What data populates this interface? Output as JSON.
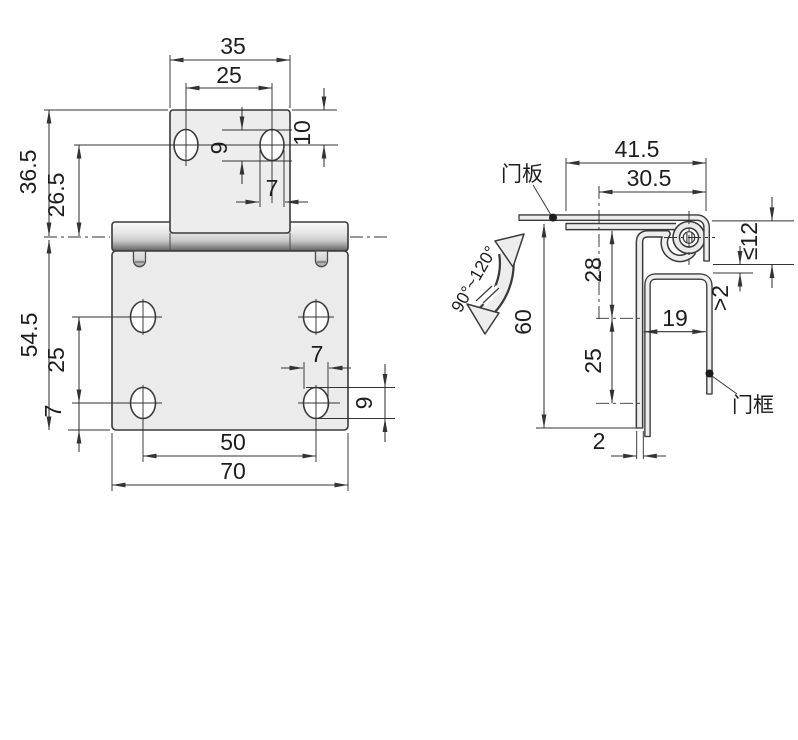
{
  "front_view": {
    "dims": {
      "tab_width": "35",
      "tab_hole_spacing": "25",
      "hole_top_offset": "10",
      "slot_height_top": "9",
      "slot_width_top": "7",
      "tab_height_to_axis": "36.5",
      "hole_to_axis": "26.5",
      "plate_height": "54.5",
      "plate_hole_spacing_v": "25",
      "hole_bottom_offset": "7",
      "slot_width_bottom": "7",
      "slot_height_bottom": "9",
      "plate_hole_spacing_h": "50",
      "plate_width": "70"
    }
  },
  "side_view": {
    "dims": {
      "leaf_width": "41.5",
      "hole_plane_offset": "30.5",
      "flange_depth": "≤12",
      "clearance": ">2",
      "first_hole_distance": "28",
      "channel_width": "19",
      "leaf_length": "60",
      "hole_spacing": "25",
      "sheet_thickness": "2",
      "opening_angle": "90°~120°"
    },
    "labels": {
      "door_panel": "门板",
      "door_frame": "门框"
    }
  }
}
